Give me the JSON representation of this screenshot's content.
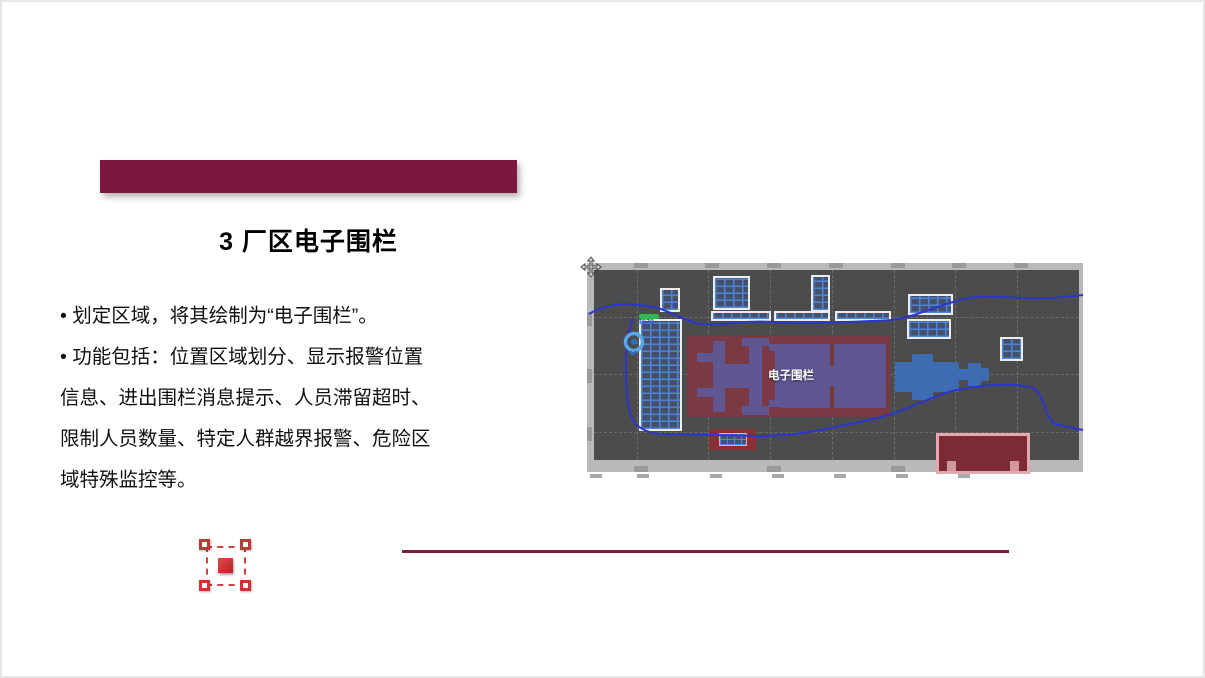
{
  "header": {
    "title": "3 厂区电子围栏",
    "banner_color": "#7e1740"
  },
  "body": {
    "lines": [
      "• 划定区域，将其绘制为“电子围栏”。",
      "• 功能包括：位置区域划分、显示报警位置",
      "信息、进出围栏消息提示、人员滞留超时、",
      "限制人员数量、特定人群越界报警、危险区",
      "域特殊监控等。"
    ]
  },
  "footer": {
    "divider_color": "#7a1f3c"
  },
  "map": {
    "fence_label": "电子围栏",
    "tag_label": "T670",
    "icons": [
      "move-cursor-icon",
      "location-pin-icon"
    ],
    "colors": {
      "frame": "#b9b9b9",
      "background": "#4c4c4c",
      "fence_fill": "#7b3a43",
      "machine_purple": "#5f5692",
      "machine_blue": "#3e6cb3",
      "grid_blue": "#4d86d8",
      "path_blue": "#2b35cf",
      "green_bar": "#2fbb4f",
      "alarm_red": "#8a2f36",
      "pink_border": "#e2a9b0"
    }
  },
  "selection_icon": {
    "name": "fence-selection-icon",
    "color": "#c93434"
  }
}
